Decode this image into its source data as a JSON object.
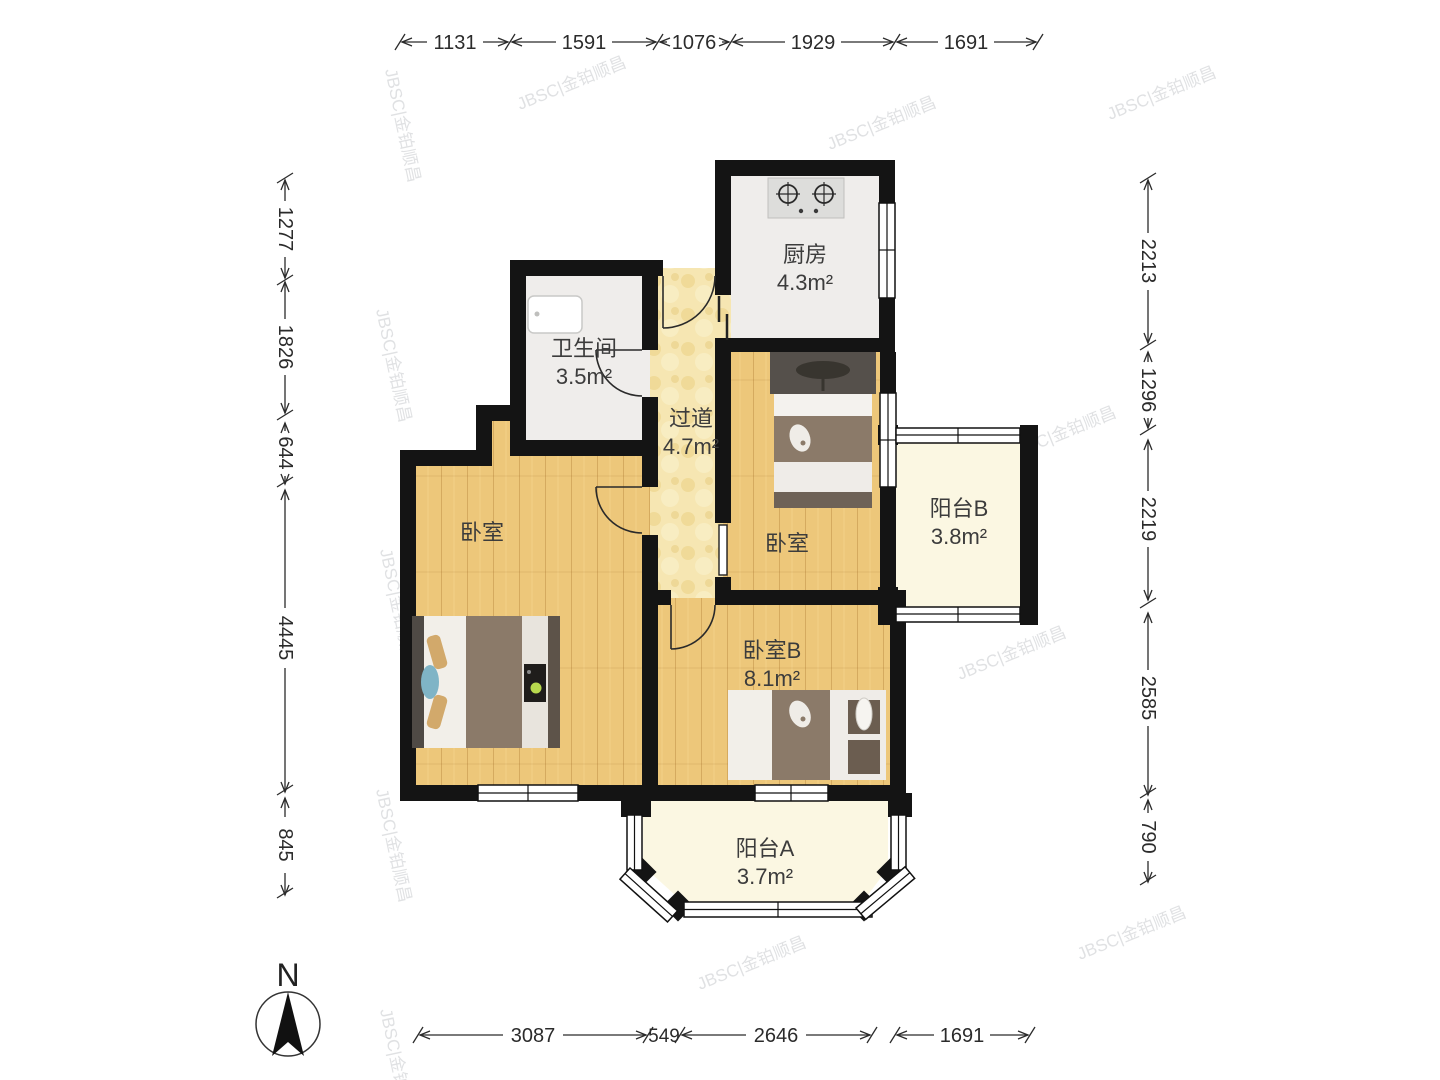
{
  "dims": {
    "top": [
      "1131",
      "1591",
      "1076",
      "1929",
      "1691"
    ],
    "left": [
      "1277",
      "1826",
      "644",
      "4445",
      "845"
    ],
    "right": [
      "2213",
      "1296",
      "2219",
      "2585",
      "790"
    ],
    "bottom": [
      "3087",
      "549",
      "2646",
      "1691"
    ]
  },
  "rooms": {
    "kitchen": {
      "name": "厨房",
      "area": "4.3m²"
    },
    "bathroom": {
      "name": "卫生间",
      "area": "3.5m²"
    },
    "hallway": {
      "name": "过道",
      "area": "4.7m²"
    },
    "bedroom_right": {
      "name": "卧室"
    },
    "bedroom_left": {
      "name": "卧室"
    },
    "bedroom_b": {
      "name": "卧室B",
      "area": "8.1m²"
    },
    "balcony_b": {
      "name": "阳台B",
      "area": "3.8m²"
    },
    "balcony_a": {
      "name": "阳台A",
      "area": "3.7m²"
    }
  },
  "compass": {
    "label": "N"
  },
  "watermark": {
    "text": "JBSC|金铂顺昌"
  },
  "colors": {
    "wall": "#141414",
    "wood_floor": "#edc77a",
    "hall_floor": "#f6e6b2",
    "tile_floor": "#efedeb",
    "balcony_floor": "#fbf7e2",
    "bed_blanket": "#8b7a69",
    "bed_dark": "#4f4a45",
    "dim_text": "#2b2b2b"
  }
}
